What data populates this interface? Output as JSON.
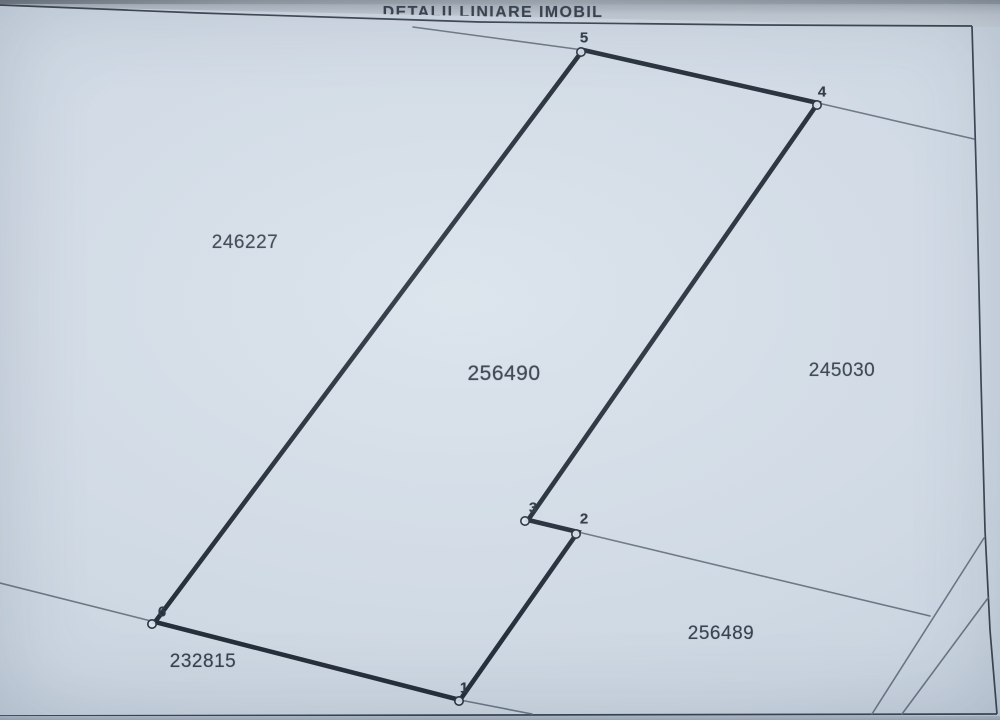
{
  "title": "DETALII LINIARE IMOBIL",
  "title_pos": {
    "x": 493,
    "y": 13
  },
  "map": {
    "parcel_labels": [
      {
        "id": "246227",
        "x": 245,
        "y": 243,
        "size": 19
      },
      {
        "id": "256490",
        "x": 504,
        "y": 374,
        "size": 21,
        "emphasis": true
      },
      {
        "id": "245030",
        "x": 842,
        "y": 371,
        "size": 19
      },
      {
        "id": "256489",
        "x": 721,
        "y": 634,
        "size": 19
      },
      {
        "id": "232815",
        "x": 203,
        "y": 662,
        "size": 19
      }
    ],
    "vertices": [
      {
        "n": "5",
        "px": 583,
        "py": 50,
        "cx": 581,
        "cy": 52,
        "lx": 584,
        "ly": 38
      },
      {
        "n": "4",
        "px": 818,
        "py": 103,
        "cx": 817,
        "cy": 105,
        "lx": 822,
        "ly": 92
      },
      {
        "n": "3",
        "px": 528,
        "py": 520,
        "cx": 525,
        "cy": 521,
        "lx": 533,
        "ly": 508
      },
      {
        "n": "2",
        "px": 578,
        "py": 532,
        "cx": 576,
        "cy": 534,
        "lx": 584,
        "ly": 519
      },
      {
        "n": "1",
        "px": 460,
        "py": 700,
        "cx": 459,
        "cy": 701,
        "lx": 464,
        "ly": 688
      },
      {
        "n": "6",
        "px": 155,
        "py": 622,
        "cx": 152,
        "cy": 624,
        "lx": 162,
        "ly": 612
      }
    ],
    "parcel_polygon": [
      [
        583,
        50
      ],
      [
        818,
        103
      ],
      [
        528,
        520
      ],
      [
        578,
        532
      ],
      [
        460,
        700
      ],
      [
        155,
        622
      ]
    ],
    "boundary_lines": [
      {
        "name": "boundary-to-vertex-5",
        "pts": [
          [
            413,
            27
          ],
          [
            583,
            50
          ]
        ]
      },
      {
        "name": "boundary-from-vertex-4",
        "pts": [
          [
            818,
            103
          ],
          [
            974,
            139
          ]
        ]
      },
      {
        "name": "boundary-from-vertex-2",
        "pts": [
          [
            578,
            532
          ],
          [
            930,
            616
          ]
        ]
      },
      {
        "name": "boundary-diagonal-a",
        "pts": [
          [
            984,
            538
          ],
          [
            872,
            714
          ]
        ]
      },
      {
        "name": "boundary-diagonal-b",
        "pts": [
          [
            988,
            598
          ],
          [
            902,
            714
          ]
        ]
      },
      {
        "name": "boundary-from-vertex-6",
        "pts": [
          [
            155,
            622
          ],
          [
            0,
            583
          ]
        ]
      },
      {
        "name": "boundary-from-vertex-1",
        "pts": [
          [
            460,
            700
          ],
          [
            532,
            714
          ]
        ]
      }
    ],
    "frame_lines": [
      {
        "name": "frame-top",
        "pts": [
          [
            0,
            5
          ],
          [
            200,
            13
          ],
          [
            480,
            22
          ],
          [
            760,
            25
          ],
          [
            972,
            26
          ]
        ]
      },
      {
        "name": "frame-right",
        "pts": [
          [
            972,
            26
          ],
          [
            977,
            200
          ],
          [
            981,
            380
          ],
          [
            985,
            530
          ],
          [
            990,
            630
          ],
          [
            997,
            714
          ]
        ]
      },
      {
        "name": "frame-bottom",
        "pts": [
          [
            0,
            716
          ],
          [
            500,
            715
          ],
          [
            997,
            714
          ]
        ]
      }
    ]
  },
  "colors": {
    "line_thick": "#232d39",
    "line_thin": "#6b7685",
    "frame": "#39434f",
    "marker_fill": "#dde5ee",
    "marker_stroke": "#273240"
  }
}
